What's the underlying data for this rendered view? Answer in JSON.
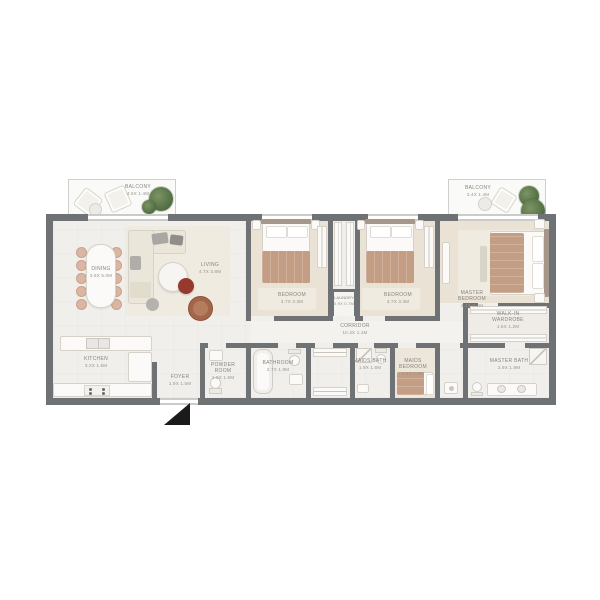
{
  "rooms": {
    "balcony_left": {
      "name": "BALCONY",
      "dims": "4.6x 1.4M"
    },
    "dining": {
      "name": "DINING",
      "dims": "3.8x 5.0M"
    },
    "living": {
      "name": "LIVING",
      "dims": "4.7x 3.8M"
    },
    "kitchen": {
      "name": "KITCHEN",
      "dims": "3.2x 1.6M"
    },
    "foyer": {
      "name": "FOYER",
      "dims": "1.9x 1.5M"
    },
    "powder": {
      "name": "POWDER ROOM",
      "dims": "1.9x 1.6M"
    },
    "bathroom": {
      "name": "BATHROOM",
      "dims": "2.7x 1.9M"
    },
    "bedroom1": {
      "name": "BEDROOM",
      "dims": "3.7x 3.3M"
    },
    "bedroom2": {
      "name": "BEDROOM",
      "dims": "3.7x 3.3M"
    },
    "laundry": {
      "name": "LAUNDRY",
      "dims": "0.9x 0.7M"
    },
    "corridor": {
      "name": "CORRIDOR",
      "dims": "10.4x 1.1M"
    },
    "maids_bath": {
      "name": "MAIDS BATH",
      "dims": "1.9x 1.6M"
    },
    "maids_bedroom": {
      "name": "MAIDS BEDROOM",
      "dims": "2.4x 1.9M"
    },
    "master_bedroom": {
      "name": "MASTER BEDROOM",
      "dims": "4.4x 3.2M"
    },
    "walkin": {
      "name": "WALK-IN WARDROBE",
      "dims": "1.5x 1.2M"
    },
    "master_bath": {
      "name": "MASTER BATH",
      "dims": "2.9x 1.9M"
    },
    "balcony_right": {
      "name": "BALCONY",
      "dims": "3.4x 1.4M"
    }
  },
  "colors": {
    "wall": "#6f7275",
    "floor": "#f1efeb",
    "floorTint": "#f3f2ee",
    "carpet": "#e9e2d5",
    "rug": "#f0ebe1",
    "bedBlanket": "#c39e85",
    "headboard": "#a5988a",
    "furnFill": "#fbfaf8",
    "furnLine": "#d6d2ca",
    "accentRed": "#96392e",
    "chairTan": "#dbb6a2",
    "chairLine": "#c8a28d",
    "armBrown": "#a3664a",
    "plantDark": "#4e6a3f",
    "plantLight": "#7b9465",
    "labelColor": "#87857f",
    "balconyBg": "#fafaf8",
    "balconyLine": "#cfcfcb",
    "windowLight": "#cbcbc7",
    "marker": "#1a1a1a"
  }
}
